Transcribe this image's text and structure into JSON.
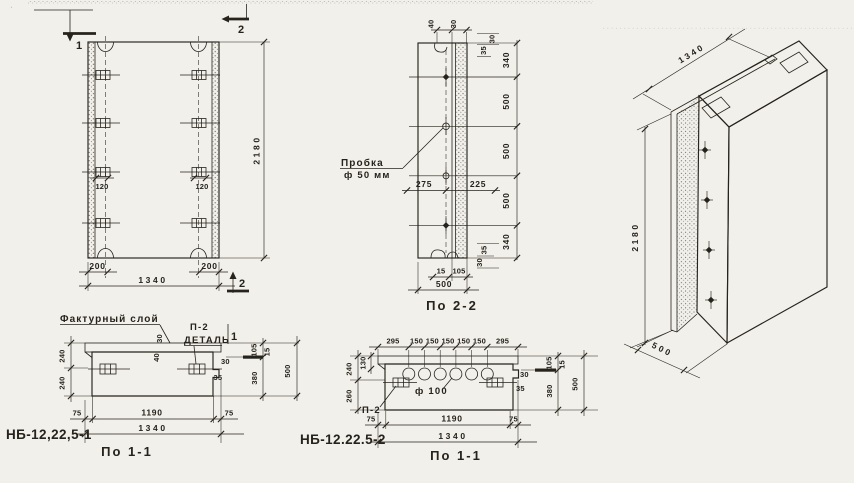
{
  "palette": {
    "paper": "#f2f0ea",
    "ink": "#26221c"
  },
  "front": {
    "flag_1": "1",
    "flag_2_top": "2",
    "flag_2_bottom": "2",
    "dim_height": "2180",
    "dim_width": "1340",
    "dim_edge_left": "200",
    "dim_edge_right": "200",
    "dim_anchor_left": "120",
    "dim_anchor_right": "120"
  },
  "sec22": {
    "title": "По 2-2",
    "plug_label": "Пробка",
    "plug_dia": "ф 50 мм",
    "right_dims": [
      "340",
      "500",
      "500",
      "500",
      "340"
    ],
    "top_40": "40",
    "top_30": "30",
    "tr_30": "30",
    "tr_35": "35",
    "br_35": "35",
    "br_30": "30",
    "dim_275": "275",
    "dim_225": "225",
    "bottom_15": "15",
    "bottom_105": "105",
    "bottom_500": "500"
  },
  "iso": {
    "dim_width": "1340",
    "dim_height": "2180",
    "dim_depth": "500"
  },
  "sec11a": {
    "mark": "НБ-12,22,5-1",
    "title": "По 1-1",
    "facture_label": "Фактурный слой",
    "detail_ref": "П-2",
    "detail_word": "ДЕТАЛЬ",
    "flag_1": "1",
    "layer_30": "30",
    "layer_40": "40",
    "left_240_top": "240",
    "left_240_bottom": "240",
    "notch_30": "30",
    "notch_35": "35",
    "right_105": "105",
    "right_15": "15",
    "right_380": "380",
    "right_500": "500",
    "bottom_75_left": "75",
    "bottom_1190": "1190",
    "bottom_75_right": "75",
    "bottom_1340": "1340"
  },
  "sec11b": {
    "mark": "НБ-12.22.5-2",
    "title": "По 1-1",
    "top_dims": [
      "295",
      "150",
      "150",
      "150",
      "150",
      "150",
      "295"
    ],
    "hole_dia": "ф 100",
    "detail_ref": "П-2",
    "left_240": "240",
    "left_130": "130",
    "left_260": "260",
    "notch_30": "30",
    "notch_35": "35",
    "right_105": "105",
    "right_15": "15",
    "right_380": "380",
    "right_500": "500",
    "bottom_75_left": "75",
    "bottom_1190": "1190",
    "bottom_75_right": "75",
    "bottom_1340": "1340"
  }
}
